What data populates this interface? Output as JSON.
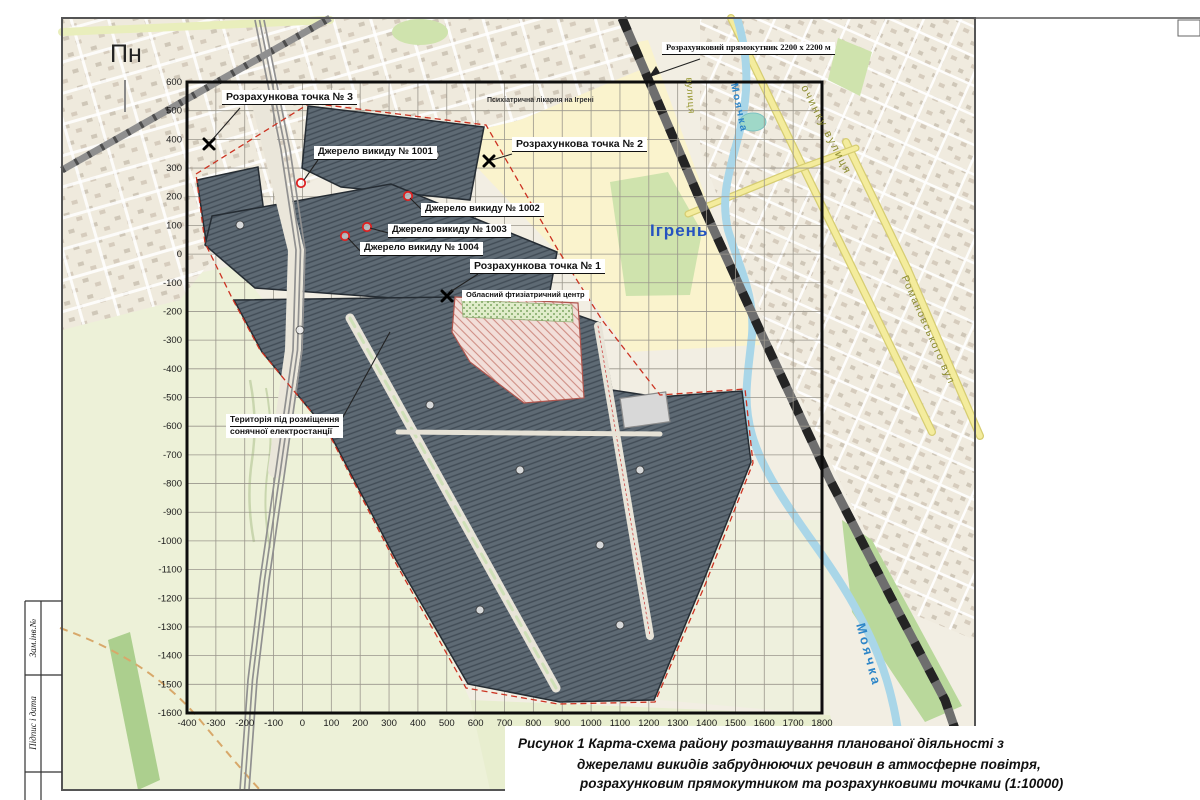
{
  "compass": {
    "north": "Пн"
  },
  "annotations": {
    "calc_rectangle_label": "Розрахунковий прямокутник 2200 х 2200 м",
    "calc_points": [
      {
        "label": "Розрахункова точка № 1"
      },
      {
        "label": "Розрахункова точка № 2"
      },
      {
        "label": "Розрахункова точка № 3"
      }
    ],
    "emission_sources": [
      {
        "label": "Джерело викиду № 1001"
      },
      {
        "label": "Джерело викиду № 1002"
      },
      {
        "label": "Джерело викиду № 1003"
      },
      {
        "label": "Джерело викиду № 1004"
      }
    ],
    "territory_line1": "Територія під розміщення",
    "territory_line2": "сонячної електростанції",
    "hospital": "Психіатрична лікарня на Ігрені",
    "medical_center": "Обласний фтизіатричний центр"
  },
  "map_labels": {
    "city": "Ігрень",
    "river_top": "Моячка",
    "river_bottom": "Моячка",
    "street_top_right": "очинку вулиця",
    "street_right": "Романовського вул",
    "street_small": "вулиця"
  },
  "axes": {
    "x_ticks": [
      -400,
      -300,
      -200,
      -100,
      0,
      100,
      200,
      300,
      400,
      500,
      600,
      700,
      800,
      900,
      1000,
      1100,
      1200,
      1300,
      1400,
      1500,
      1600,
      1700,
      1800
    ],
    "y_ticks": [
      600,
      500,
      400,
      300,
      200,
      100,
      0,
      -100,
      -200,
      -300,
      -400,
      -500,
      -600,
      -700,
      -800,
      -900,
      -1000,
      -1100,
      -1200,
      -1300,
      -1400,
      -1500,
      -1600
    ]
  },
  "caption": {
    "line1": "Рисунок 1  Карта-схема району розташування планованої діяльності з",
    "line2": "джерелами викидів забруднюючих речовин в атмосферне повітря,",
    "line3": "розрахунковим прямокутником та розрахунковими точками (1:10000)"
  },
  "frame": {
    "cell1": "Зам.інв.№",
    "cell2": "Підпис і дата"
  },
  "colors": {
    "site_fill": "#5e6a74",
    "site_hatch": "#414c56",
    "boundary_red": "#cc3322",
    "river_blue": "#a9d6e8",
    "label_blue": "#2553c0",
    "map_beige": "#f2eee3",
    "fields_green": "#edf1d8",
    "hospital_yellow": "#faf3cd",
    "road_yellow": "#f4ec9d"
  }
}
